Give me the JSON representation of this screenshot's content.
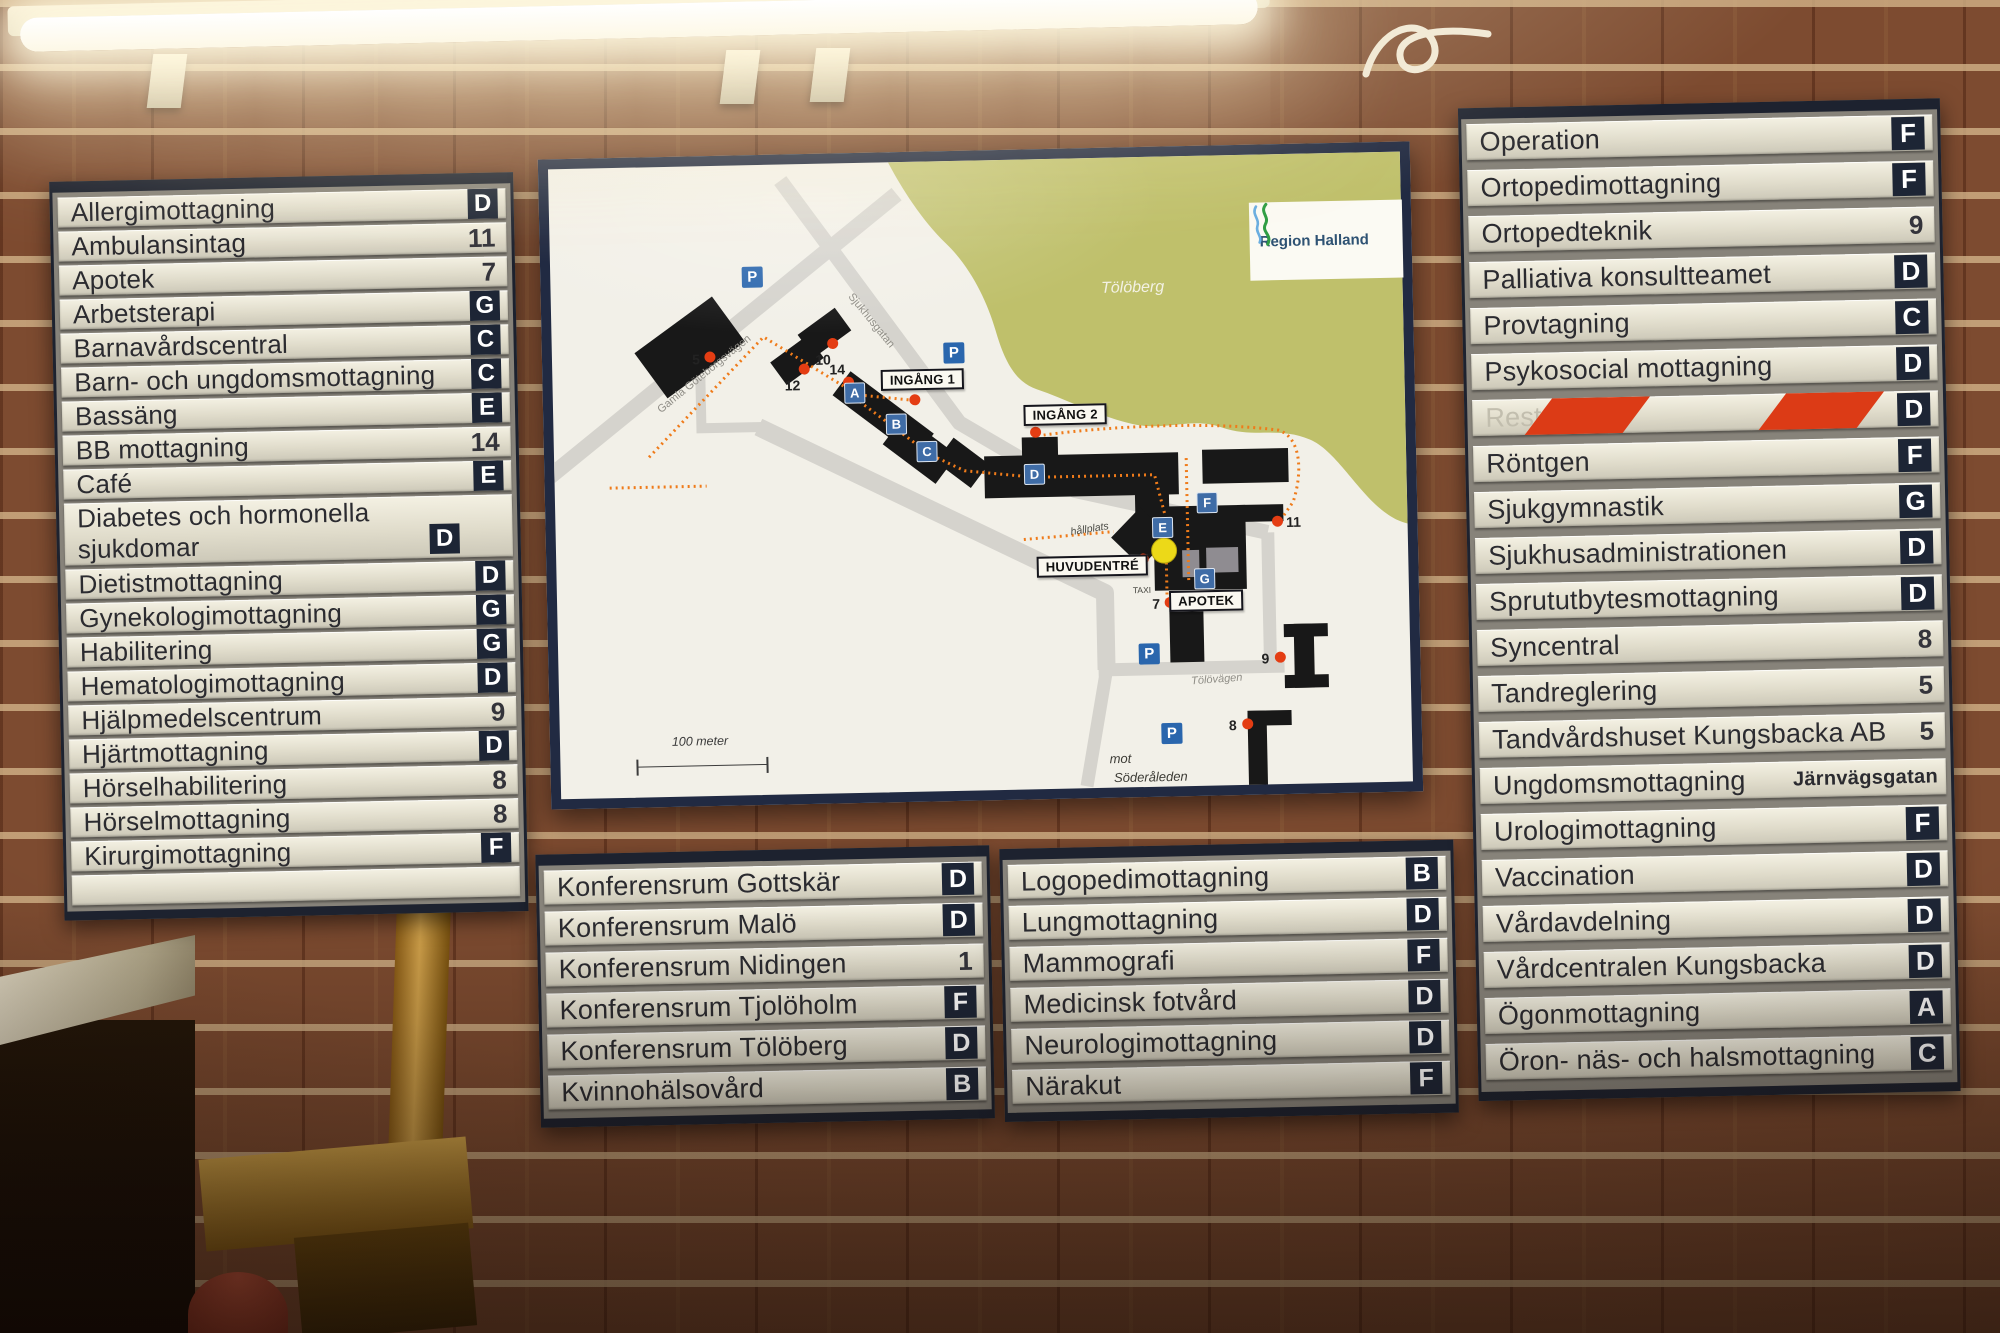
{
  "panels": {
    "left": {
      "rows": [
        {
          "label": "Allergimottagning",
          "badge": "D",
          "type": "letter"
        },
        {
          "label": "Ambulansintag",
          "badge": "11",
          "type": "number"
        },
        {
          "label": "Apotek",
          "badge": "7",
          "type": "number"
        },
        {
          "label": "Arbetsterapi",
          "badge": "G",
          "type": "letter"
        },
        {
          "label": "Barnavårdscentral",
          "badge": "C",
          "type": "letter"
        },
        {
          "label": "Barn- och ungdomsmottagning",
          "badge": "C",
          "type": "letter"
        },
        {
          "label": "Bassäng",
          "badge": "E",
          "type": "letter"
        },
        {
          "label": "BB mottagning",
          "badge": "14",
          "type": "number"
        },
        {
          "label": "Café",
          "badge": "E",
          "type": "letter"
        },
        {
          "label": "Diabetes och hormonella sjukdomar",
          "badge": "D",
          "type": "letter",
          "tall": true
        },
        {
          "label": "Dietistmottagning",
          "badge": "D",
          "type": "letter"
        },
        {
          "label": "Gynekologimottagning",
          "badge": "G",
          "type": "letter"
        },
        {
          "label": "Habilitering",
          "badge": "G",
          "type": "letter"
        },
        {
          "label": "Hematologimottagning",
          "badge": "D",
          "type": "letter"
        },
        {
          "label": "Hjälpmedelscentrum",
          "badge": "9",
          "type": "number"
        },
        {
          "label": "Hjärtmottagning",
          "badge": "D",
          "type": "letter"
        },
        {
          "label": "Hörselhabilitering",
          "badge": "8",
          "type": "number"
        },
        {
          "label": "Hörselmottagning",
          "badge": "8",
          "type": "number"
        },
        {
          "label": "Kirurgimottagning",
          "badge": "F",
          "type": "letter"
        },
        {
          "label": "",
          "badge": "",
          "type": "none"
        }
      ]
    },
    "bottom_left": {
      "rows": [
        {
          "label": "Konferensrum Gottskär",
          "badge": "D",
          "type": "letter"
        },
        {
          "label": "Konferensrum Malö",
          "badge": "D",
          "type": "letter"
        },
        {
          "label": "Konferensrum Nidingen",
          "badge": "1",
          "type": "number"
        },
        {
          "label": "Konferensrum Tjolöholm",
          "badge": "F",
          "type": "letter"
        },
        {
          "label": "Konferensrum Tölöberg",
          "badge": "D",
          "type": "letter"
        },
        {
          "label": "Kvinnohälsovård",
          "badge": "B",
          "type": "letter"
        }
      ]
    },
    "bottom_right": {
      "rows": [
        {
          "label": "Logopedimottagning",
          "badge": "B",
          "type": "letter"
        },
        {
          "label": "Lungmottagning",
          "badge": "D",
          "type": "letter"
        },
        {
          "label": "Mammografi",
          "badge": "F",
          "type": "letter"
        },
        {
          "label": "Medicinsk fotvård",
          "badge": "D",
          "type": "letter"
        },
        {
          "label": "Neurologimottagning",
          "badge": "D",
          "type": "letter"
        },
        {
          "label": "Närakut",
          "badge": "F",
          "type": "letter"
        }
      ]
    },
    "right": {
      "rows": [
        {
          "label": "Operation",
          "badge": "F",
          "type": "letter"
        },
        {
          "label": "Ortopedimottagning",
          "badge": "F",
          "type": "letter"
        },
        {
          "label": "Ortopedteknik",
          "badge": "9",
          "type": "number"
        },
        {
          "label": "Palliativa konsultteamet",
          "badge": "D",
          "type": "letter"
        },
        {
          "label": "Provtagning",
          "badge": "C",
          "type": "letter"
        },
        {
          "label": "Psykosocial mottagning",
          "badge": "D",
          "type": "letter"
        },
        {
          "label": "Restaurang",
          "badge": "D",
          "type": "letter",
          "blocked": true
        },
        {
          "label": "Röntgen",
          "badge": "F",
          "type": "letter"
        },
        {
          "label": "Sjukgymnastik",
          "badge": "G",
          "type": "letter"
        },
        {
          "label": "Sjukhusadministrationen",
          "badge": "D",
          "type": "letter"
        },
        {
          "label": "Sprututbytesmottagning",
          "badge": "D",
          "type": "letter"
        },
        {
          "label": "Syncentral",
          "badge": "8",
          "type": "number"
        },
        {
          "label": "Tandreglering",
          "badge": "5",
          "type": "number"
        },
        {
          "label": "Tandvårdshuset Kungsbacka AB",
          "badge": "5",
          "type": "number"
        },
        {
          "label": "Ungdomsmottagning",
          "badge": "Järnvägsgatan",
          "type": "text"
        },
        {
          "label": "Urologimottagning",
          "badge": "F",
          "type": "letter"
        },
        {
          "label": "Vaccination",
          "badge": "D",
          "type": "letter"
        },
        {
          "label": "Vårdavdelning",
          "badge": "D",
          "type": "letter"
        },
        {
          "label": "Vårdcentralen Kungsbacka",
          "badge": "D",
          "type": "letter"
        },
        {
          "label": "Ögonmottagning",
          "badge": "A",
          "type": "letter"
        },
        {
          "label": "Öron- näs- och halsmottagning",
          "badge": "C",
          "type": "letter"
        }
      ]
    }
  },
  "map": {
    "logo_text": "Region Halland",
    "hill_label": "Tölöberg",
    "scale_label": "100 meter",
    "parking_glyph": "P",
    "road_labels": [
      {
        "text": "Gamla Göteborgsvägen",
        "x": 152,
        "y": 208,
        "rot": -38,
        "cls": "road"
      },
      {
        "text": "Sjukhusgatan",
        "x": 320,
        "y": 158,
        "rot": 52,
        "cls": "road"
      },
      {
        "text": "Tölövägen",
        "x": 658,
        "y": 524,
        "rot": -3,
        "cls": "roadsm"
      },
      {
        "text": "hållplats",
        "x": 534,
        "y": 371,
        "rot": -8,
        "cls": "smitalic"
      },
      {
        "text": "TAXI",
        "x": 585,
        "y": 433,
        "rot": 0,
        "cls": "tiny"
      },
      {
        "text": "mot",
        "x": 560,
        "y": 601,
        "rot": 0,
        "cls": "dest"
      },
      {
        "text": "Söderåleden",
        "x": 590,
        "y": 620,
        "rot": 0,
        "cls": "dest"
      }
    ],
    "entrance_boxes": [
      {
        "text": "INGÅNG 1",
        "x": 370,
        "y": 218
      },
      {
        "text": "INGÅNG 2",
        "x": 512,
        "y": 256
      },
      {
        "text": "HUVUDENTRÉ",
        "x": 536,
        "y": 408
      },
      {
        "text": "APOTEK",
        "x": 649,
        "y": 445
      }
    ],
    "letter_markers": [
      {
        "t": "A",
        "x": 302,
        "y": 230
      },
      {
        "t": "B",
        "x": 343,
        "y": 262
      },
      {
        "t": "C",
        "x": 373,
        "y": 290
      },
      {
        "t": "D",
        "x": 480,
        "y": 315
      },
      {
        "t": "E",
        "x": 607,
        "y": 371
      },
      {
        "t": "F",
        "x": 652,
        "y": 347
      },
      {
        "t": "G",
        "x": 648,
        "y": 423
      }
    ],
    "parking_markers": [
      {
        "x": 202,
        "y": 112
      },
      {
        "x": 402,
        "y": 192
      },
      {
        "x": 591,
        "y": 497
      },
      {
        "x": 612,
        "y": 577
      }
    ],
    "number_markers": [
      {
        "n": "5",
        "dot": [
          158,
          191
        ],
        "lab": [
          144,
          193
        ]
      },
      {
        "n": "10",
        "dot": [
          281,
          180
        ],
        "lab": [
          271,
          196
        ]
      },
      {
        "n": "12",
        "dot": [
          252,
          205
        ],
        "lab": [
          240,
          221
        ]
      },
      {
        "n": "14",
        "dot": [
          296,
          219
        ],
        "lab": [
          285,
          206
        ]
      },
      {
        "n": "11",
        "dot": [
          722,
          367
        ],
        "lab": [
          738,
          368
        ]
      },
      {
        "n": "7",
        "dot": [
          613,
          446
        ],
        "lab": [
          599,
          447
        ]
      },
      {
        "n": "9",
        "dot": [
          722,
          503
        ],
        "lab": [
          707,
          504
        ]
      },
      {
        "n": "8",
        "dot": [
          688,
          569
        ],
        "lab": [
          673,
          570
        ]
      }
    ],
    "entrance_dots": [
      [
        362,
        238
      ],
      [
        482,
        273
      ],
      [
        587,
        402
      ]
    ],
    "you_are_here": [
      608,
      394
    ]
  }
}
